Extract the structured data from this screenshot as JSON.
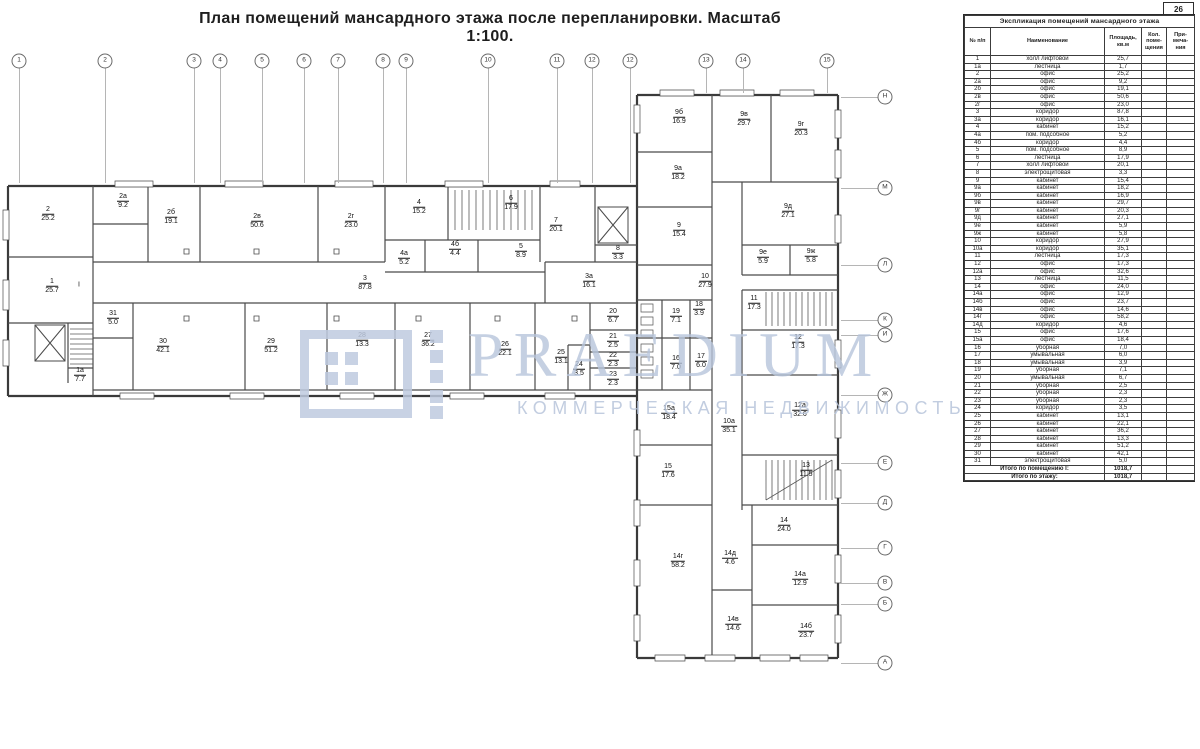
{
  "page": {
    "title": "План помещений мансардного этажа после  перепланировки. Масштаб 1:100.",
    "page_number": "26"
  },
  "watermark": {
    "brand": "PRAEDIUM",
    "tagline": "КОММЕРЧЕСКАЯ НЕДВИЖИМОСТЬ",
    "color": "#b7c4db"
  },
  "plan": {
    "grid_columns": [
      {
        "label": "1",
        "x": 19
      },
      {
        "label": "2",
        "x": 105
      },
      {
        "label": "3",
        "x": 194
      },
      {
        "label": "4",
        "x": 220
      },
      {
        "label": "5",
        "x": 262
      },
      {
        "label": "6",
        "x": 304
      },
      {
        "label": "7",
        "x": 338
      },
      {
        "label": "8",
        "x": 383
      },
      {
        "label": "9",
        "x": 406
      },
      {
        "label": "10",
        "x": 488
      },
      {
        "label": "11",
        "x": 557
      },
      {
        "label": "12",
        "x": 592
      },
      {
        "label": "12",
        "x": 630
      },
      {
        "label": "13",
        "x": 706
      },
      {
        "label": "14",
        "x": 743
      },
      {
        "label": "15",
        "x": 827
      }
    ],
    "grid_rows": [
      {
        "label": "Н",
        "y": 97
      },
      {
        "label": "М",
        "y": 188
      },
      {
        "label": "Л",
        "y": 265
      },
      {
        "label": "К",
        "y": 320
      },
      {
        "label": "И",
        "y": 335
      },
      {
        "label": "Ж",
        "y": 395
      },
      {
        "label": "Е",
        "y": 463
      },
      {
        "label": "Д",
        "y": 503
      },
      {
        "label": "Г",
        "y": 548
      },
      {
        "label": "В",
        "y": 583
      },
      {
        "label": "Б",
        "y": 604
      },
      {
        "label": "А",
        "y": 663
      }
    ],
    "rooms": [
      {
        "id": "2",
        "area": "25.2",
        "x": 48,
        "y": 214
      },
      {
        "id": "2а",
        "area": "9.2",
        "x": 123,
        "y": 201
      },
      {
        "id": "2б",
        "area": "19.1",
        "x": 171,
        "y": 217
      },
      {
        "id": "2в",
        "area": "50.6",
        "x": 257,
        "y": 221
      },
      {
        "id": "2г",
        "area": "23.0",
        "x": 351,
        "y": 221
      },
      {
        "id": "4",
        "area": "15.2",
        "x": 419,
        "y": 207
      },
      {
        "id": "6",
        "area": "17.9",
        "x": 511,
        "y": 203
      },
      {
        "id": "4а",
        "area": "5.2",
        "x": 404,
        "y": 258
      },
      {
        "id": "4б",
        "area": "4.4",
        "x": 455,
        "y": 249
      },
      {
        "id": "5",
        "area": "8.9",
        "x": 521,
        "y": 251
      },
      {
        "id": "7",
        "area": "20.1",
        "x": 556,
        "y": 225
      },
      {
        "id": "8",
        "area": "3.3",
        "x": 618,
        "y": 253
      },
      {
        "id": "1",
        "area": "25.7",
        "x": 52,
        "y": 286
      },
      {
        "id": "I",
        "area": "",
        "x": 79,
        "y": 285
      },
      {
        "id": "3",
        "area": "87.8",
        "x": 365,
        "y": 283
      },
      {
        "id": "3а",
        "area": "16.1",
        "x": 589,
        "y": 281
      },
      {
        "id": "31",
        "area": "5.0",
        "x": 113,
        "y": 318
      },
      {
        "id": "30",
        "area": "42.1",
        "x": 163,
        "y": 346
      },
      {
        "id": "29",
        "area": "51.2",
        "x": 271,
        "y": 346
      },
      {
        "id": "28",
        "area": "13.3",
        "x": 362,
        "y": 340
      },
      {
        "id": "27",
        "area": "36.2",
        "x": 428,
        "y": 340
      },
      {
        "id": "26",
        "area": "22.1",
        "x": 505,
        "y": 349
      },
      {
        "id": "25",
        "area": "13.1",
        "x": 561,
        "y": 357
      },
      {
        "id": "24",
        "area": "3.5",
        "x": 579,
        "y": 369
      },
      {
        "id": "20",
        "area": "6.7",
        "x": 613,
        "y": 316
      },
      {
        "id": "21",
        "area": "2.5",
        "x": 613,
        "y": 341
      },
      {
        "id": "22",
        "area": "2.3",
        "x": 613,
        "y": 360
      },
      {
        "id": "23",
        "area": "2.3",
        "x": 613,
        "y": 379
      },
      {
        "id": "1а",
        "area": "7.7",
        "x": 80,
        "y": 375
      },
      {
        "id": "9б",
        "area": "16.9",
        "x": 679,
        "y": 117
      },
      {
        "id": "9в",
        "area": "29.7",
        "x": 744,
        "y": 119
      },
      {
        "id": "9г",
        "area": "20.3",
        "x": 801,
        "y": 129
      },
      {
        "id": "9а",
        "area": "18.2",
        "x": 678,
        "y": 173
      },
      {
        "id": "9д",
        "area": "27.1",
        "x": 788,
        "y": 211
      },
      {
        "id": "9",
        "area": "15.4",
        "x": 679,
        "y": 230
      },
      {
        "id": "9е",
        "area": "5.9",
        "x": 763,
        "y": 257
      },
      {
        "id": "9ж",
        "area": "5.8",
        "x": 811,
        "y": 256
      },
      {
        "id": "10",
        "area": "27.9",
        "x": 705,
        "y": 281
      },
      {
        "id": "11",
        "area": "17.3",
        "x": 754,
        "y": 303
      },
      {
        "id": "19",
        "area": "7.1",
        "x": 676,
        "y": 316
      },
      {
        "id": "18",
        "area": "3.9",
        "x": 699,
        "y": 309
      },
      {
        "id": "16",
        "area": "7.0",
        "x": 676,
        "y": 363
      },
      {
        "id": "17",
        "area": "6.0",
        "x": 701,
        "y": 361
      },
      {
        "id": "12",
        "area": "17.3",
        "x": 798,
        "y": 342
      },
      {
        "id": "15а",
        "area": "18.4",
        "x": 669,
        "y": 413
      },
      {
        "id": "10а",
        "area": "35.1",
        "x": 729,
        "y": 426
      },
      {
        "id": "12а",
        "area": "32.6",
        "x": 800,
        "y": 410
      },
      {
        "id": "15",
        "area": "17.6",
        "x": 668,
        "y": 471
      },
      {
        "id": "13",
        "area": "11.5",
        "x": 806,
        "y": 470
      },
      {
        "id": "14",
        "area": "24.0",
        "x": 784,
        "y": 525
      },
      {
        "id": "14г",
        "area": "58.2",
        "x": 678,
        "y": 561
      },
      {
        "id": "14д",
        "area": "4.6",
        "x": 730,
        "y": 558
      },
      {
        "id": "14а",
        "area": "12.9",
        "x": 800,
        "y": 579
      },
      {
        "id": "14в",
        "area": "14.6",
        "x": 733,
        "y": 624
      },
      {
        "id": "14б",
        "area": "23.7",
        "x": 806,
        "y": 631
      }
    ]
  },
  "table": {
    "title": "Экспликация помещений мансардного этажа",
    "columns": [
      "№ п/п",
      "Наименование",
      "Площадь, кв.м",
      "Кол. поме-щения",
      "При-меча-ния"
    ],
    "rows": [
      [
        "1",
        "холл лифтовой",
        "25,7"
      ],
      [
        "1а",
        "лестница",
        "1,7"
      ],
      [
        "2",
        "офис",
        "25,2"
      ],
      [
        "2а",
        "офис",
        "9,2"
      ],
      [
        "2б",
        "офис",
        "19,1"
      ],
      [
        "2в",
        "офис",
        "50,6"
      ],
      [
        "2г",
        "офис",
        "23,0"
      ],
      [
        "3",
        "коридор",
        "87,8"
      ],
      [
        "3а",
        "коридор",
        "16,1"
      ],
      [
        "4",
        "кабинет",
        "15,2"
      ],
      [
        "4а",
        "пом. подсобное",
        "5,2"
      ],
      [
        "4б",
        "коридор",
        "4,4"
      ],
      [
        "5",
        "пом. подсобное",
        "8,9"
      ],
      [
        "6",
        "лестница",
        "17,9"
      ],
      [
        "7",
        "холл лифтовой",
        "20,1"
      ],
      [
        "8",
        "электрощитовая",
        "3,3"
      ],
      [
        "9",
        "кабинет",
        "15,4"
      ],
      [
        "9а",
        "кабинет",
        "18,2"
      ],
      [
        "9б",
        "кабинет",
        "16,9"
      ],
      [
        "9в",
        "кабинет",
        "29,7"
      ],
      [
        "9г",
        "кабинет",
        "20,3"
      ],
      [
        "9д",
        "кабинет",
        "27,1"
      ],
      [
        "9е",
        "кабинет",
        "5,9"
      ],
      [
        "9ж",
        "кабинет",
        "5,8"
      ],
      [
        "10",
        "коридор",
        "27,9"
      ],
      [
        "10а",
        "коридор",
        "35,1"
      ],
      [
        "11",
        "лестница",
        "17,3"
      ],
      [
        "12",
        "офис",
        "17,3"
      ],
      [
        "12а",
        "офис",
        "32,6"
      ],
      [
        "13",
        "лестница",
        "11,5"
      ],
      [
        "14",
        "офис",
        "24,0"
      ],
      [
        "14а",
        "офис",
        "12,9"
      ],
      [
        "14б",
        "офис",
        "23,7"
      ],
      [
        "14в",
        "офис",
        "14,6"
      ],
      [
        "14г",
        "офис",
        "58,2"
      ],
      [
        "14д",
        "коридор",
        "4,6"
      ],
      [
        "15",
        "офис",
        "17,6"
      ],
      [
        "15а",
        "офис",
        "18,4"
      ],
      [
        "16",
        "уборная",
        "7,0"
      ],
      [
        "17",
        "умывальная",
        "6,0"
      ],
      [
        "18",
        "умывальная",
        "3,9"
      ],
      [
        "19",
        "уборная",
        "7,1"
      ],
      [
        "20",
        "умывальная",
        "6,7"
      ],
      [
        "21",
        "уборная",
        "2,5"
      ],
      [
        "22",
        "уборная",
        "2,3"
      ],
      [
        "23",
        "уборная",
        "2,3"
      ],
      [
        "24",
        "коридор",
        "3,5"
      ],
      [
        "25",
        "кабинет",
        "13,1"
      ],
      [
        "26",
        "кабинет",
        "22,1"
      ],
      [
        "27",
        "кабинет",
        "36,2"
      ],
      [
        "28",
        "кабинет",
        "13,3"
      ],
      [
        "29",
        "кабинет",
        "51,2"
      ],
      [
        "30",
        "кабинет",
        "42,1"
      ],
      [
        "31",
        "электрощитовая",
        "5,0"
      ]
    ],
    "totals": [
      [
        "Итого по помещению I:",
        "1018,7"
      ],
      [
        "Итого по этажу:",
        "1018,7"
      ]
    ]
  }
}
